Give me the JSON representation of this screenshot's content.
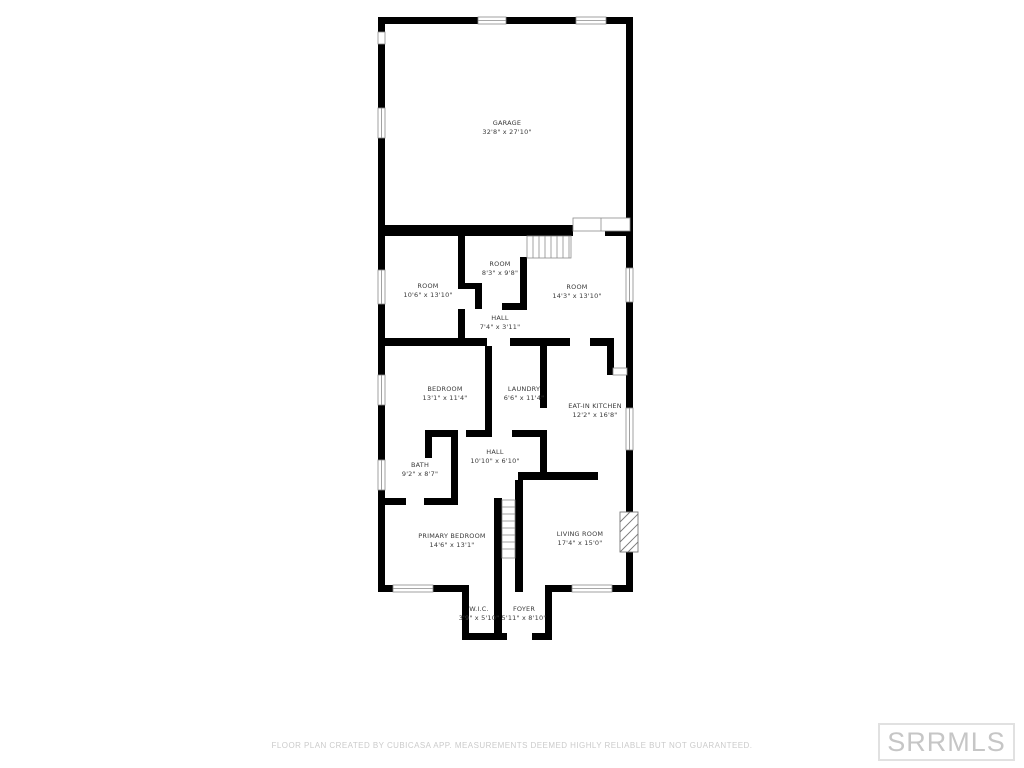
{
  "floor_plan": {
    "rooms": [
      {
        "id": "garage",
        "name": "GARAGE",
        "dims": "32'8\" x 27'10\""
      },
      {
        "id": "room-left",
        "name": "ROOM",
        "dims": "10'6\" x 13'10\""
      },
      {
        "id": "room-middle",
        "name": "ROOM",
        "dims": "8'3\" x 9'8\""
      },
      {
        "id": "room-right",
        "name": "ROOM",
        "dims": "14'3\" x 13'10\""
      },
      {
        "id": "hall-upper",
        "name": "HALL",
        "dims": "7'4\" x 3'11\""
      },
      {
        "id": "bedroom",
        "name": "BEDROOM",
        "dims": "13'1\" x 11'4\""
      },
      {
        "id": "laundry",
        "name": "LAUNDRY",
        "dims": "6'6\" x 11'4\""
      },
      {
        "id": "eat-in-kitchen",
        "name": "EAT-IN KITCHEN",
        "dims": "12'2\" x 16'8\""
      },
      {
        "id": "hall-lower",
        "name": "HALL",
        "dims": "10'10\" x 6'10\""
      },
      {
        "id": "bath",
        "name": "BATH",
        "dims": "9'2\" x 8'7\""
      },
      {
        "id": "primary-bedroom",
        "name": "PRIMARY BEDROOM",
        "dims": "14'6\" x 13'1\""
      },
      {
        "id": "living-room",
        "name": "LIVING ROOM",
        "dims": "17'4\" x 15'0\""
      },
      {
        "id": "wic",
        "name": "W.I.C.",
        "dims": "3'9\" x 5'10\""
      },
      {
        "id": "foyer",
        "name": "FOYER",
        "dims": "5'11\" x 8'10\""
      }
    ],
    "footer": "FLOOR PLAN CREATED BY CUBICASA APP. MEASUREMENTS DEEMED HIGHLY RELIABLE BUT NOT GUARANTEED.",
    "watermark": "SRRMLS",
    "colors": {
      "wall": "#000000",
      "label_text": "#3a3a3a",
      "footer_text": "#cbcbcb",
      "watermark_text": "#c6c6c6",
      "watermark_border": "#e1e1e1"
    }
  }
}
